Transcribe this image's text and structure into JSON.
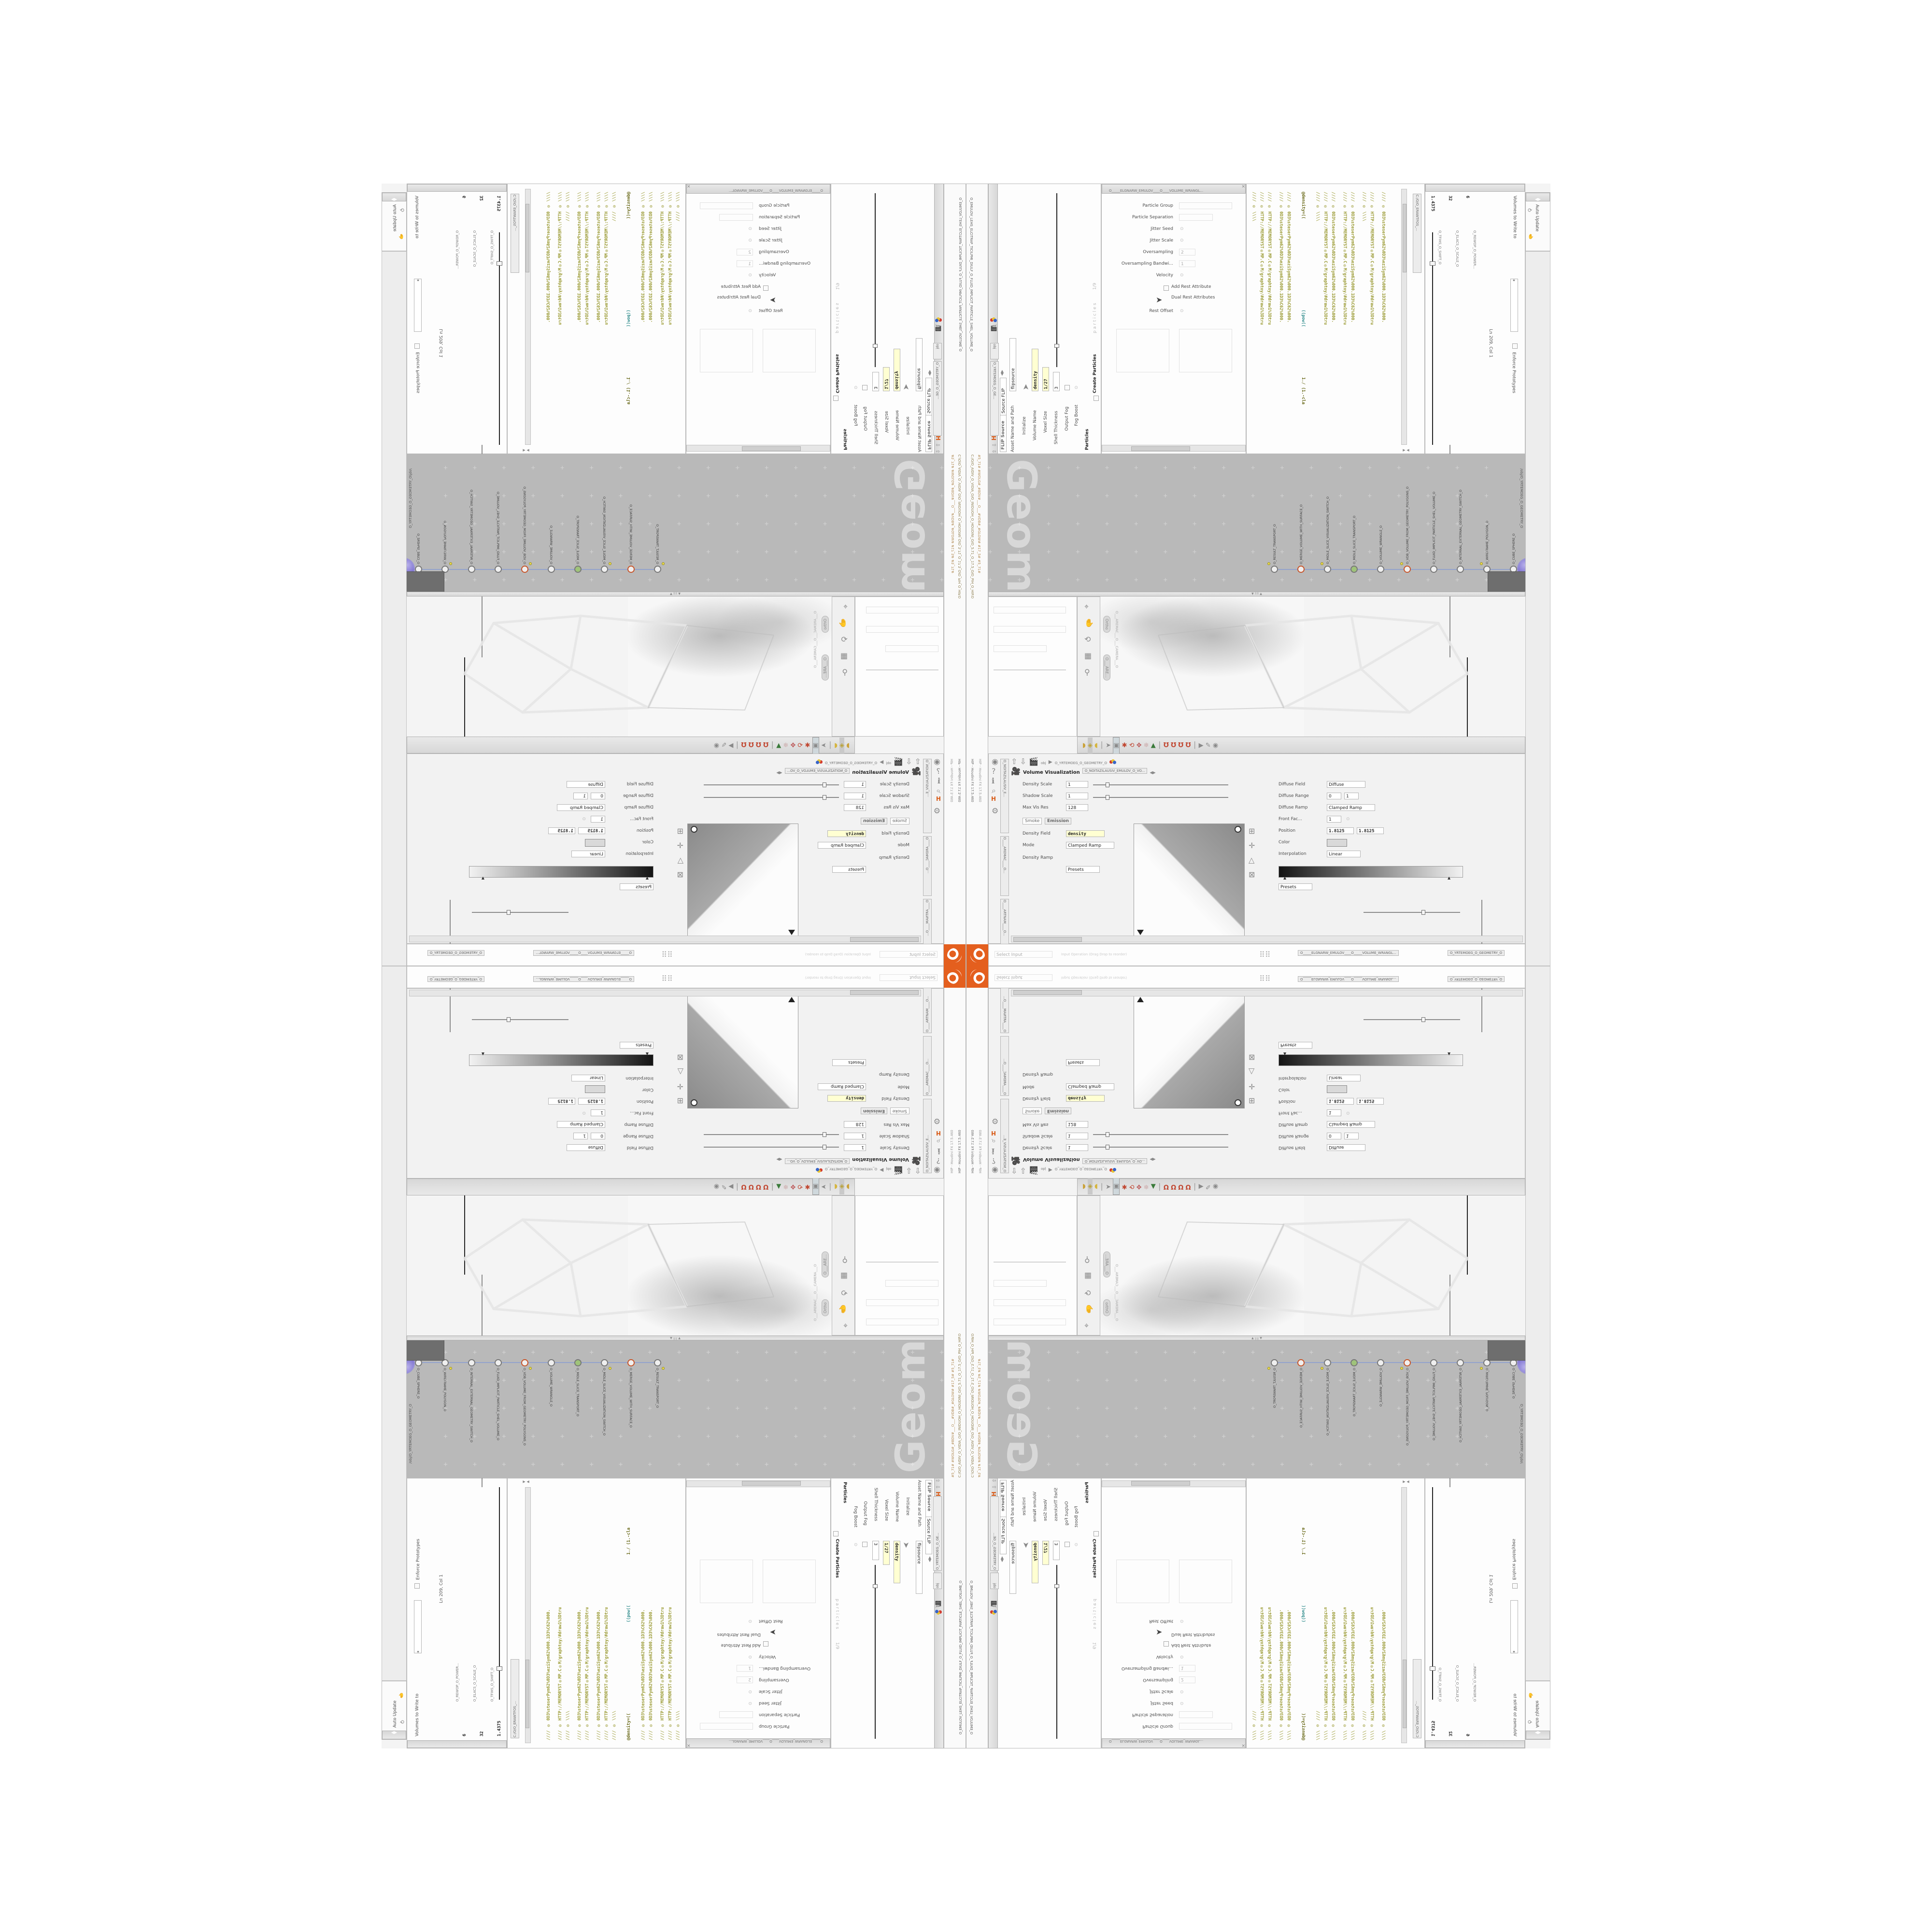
{
  "app": {
    "auto_update": "Auto Update",
    "taskbar": "HIP  -  Houdini FX 17.5.460",
    "title_path": "C:/O/O_AIDIV_O_VIDIA_O/O_INIDUOH_O_HOUDINI_O/O_5.71_O_17.5_O/O_PIH_O_HIP.O",
    "title_frames": "#5_71#   #WOLG#_#BDV#___O___#VDB#_#GLOW#   #17_5#   #5_71#"
  },
  "flip": {
    "window_tab": "O_EMULOV_LEHS_ELCITRAP_TICILPMI_DIULF_O_FLUID_IMPLICIT_PARTICLE_SHEL_VOLUME_O",
    "tab": "FLIP Source",
    "selector": "Source FLIP",
    "asset_label": "Asset Name and Path",
    "asset_value": "flipsource",
    "path_obj": "obj",
    "path_geo": "O_YRTEMOEG_O_GE...",
    "rows": [
      {
        "label": "Initialize",
        "value": ""
      },
      {
        "label": "Volume Name",
        "value": "density"
      },
      {
        "label": "Voxel Size",
        "value": "1/27"
      },
      {
        "label": "Shell Thickness",
        "value": "3"
      },
      {
        "label": "Output Fog",
        "value": ""
      },
      {
        "label": "Fog Boost",
        "value": ""
      }
    ],
    "particles_section": "Particles",
    "create_particles": "Create Particles",
    "ghost_name": "particles",
    "ghost_value": "1/9"
  },
  "pane2": {
    "tab": "O_____ELGNARW_EMULOV____O____VOLUME_WRANGL...",
    "rows": [
      {
        "label": "Particle Group",
        "value": ""
      },
      {
        "label": "Particle Separation",
        "value": ""
      },
      {
        "label": "Jitter Seed",
        "value": ""
      },
      {
        "label": "Jitter Scale",
        "value": ""
      },
      {
        "label": "Oversampling",
        "value": "2"
      },
      {
        "label": "Oversampling Bandwi...",
        "value": "1"
      },
      {
        "label": "Velocity",
        "value": ""
      }
    ],
    "add_rest": "Add Rest Attribute",
    "dual_rest": "Dual Rest Attributes",
    "rest_offset": "Rest Offset"
  },
  "wrangle": {
    "title": "Volume Wrangle",
    "asset_label": "Asset Name and Path",
    "asset_value": "volumewrangle",
    "file_tab": "C:/O/O_ERAWTFOS_...",
    "net_tab": "O_____ELGNARW_EMULOV____O_____VOLUME_WRANGL...",
    "geo_tab": "O_YRTEMOEG_O_GEOMETRY_O",
    "status": "Ln 209, Col 1",
    "volumes_label": "Volumes to Write to",
    "volumes_value": "*",
    "enforce": "Enforce Prototypes",
    "select_input": "Select Input",
    "input_op": "Input Operation (Drag Drop to reorder)",
    "params": [
      {
        "label": "O_REWOP_O_POWER...",
        "value": "6"
      },
      {
        "label": "O_ELACS_O_SCALE_O",
        "value": "32"
      },
      {
        "label": "O_TFIHS_O_SHIFT_O",
        "value": "1.4375"
      }
    ],
    "code_lines": [
      "//// ◎ \\\\\\\\",
      "//// ◎ HTTP://MEMORYST◎MP.C◎M/graphtoy/#draw1%3Dtru",
      "//// ◎ HTTP://MEMORYST◎MP.C◎M/graphtoy/#draw1%3Dtru",
      "//// ◎ 0D3%steserPym62%0D3%eziSym62%000.1D3%C62%000.",
      "//// ◎ 0D3%steserPym62%0D3%eziSym62%000.1D3%C62%000.",
      "//// ◎ \\\\\\\\",
      "//// ◎ HTTP://MEMORYST◎MP.C◎M/graphtoy/#draw1%3Dtru",
      "//// ◎ 0D3%steserPym62%0D3%eziSym62%000.1D3%C62%000."
    ],
    "code_line_main_a": "@density=((",
    "code_line_main_b": "((pow((",
    "code_line_main_c": "1./ (1.-cla"
  },
  "network": {
    "watermark": "Geometry",
    "context_tab": "/obj/O_YRTEMOEG_O_GEOMETRY_O",
    "nodes": [
      {
        "label": "O_RESULT_TRANSPORT_O"
      },
      {
        "label": "O_MERGE_VOLUME_WITH_SURFACE_O"
      },
      {
        "label": "O_MIDLE_SLICE_VISUALIZATION_SWITCH_O"
      },
      {
        "label": "O_MIDLE_SLICE_TRANSPORT_O"
      },
      {
        "label": "O_VOLUME_WRANGLE_O"
      },
      {
        "label": "O_VDB_VOLUME_FROM_GEOMETRY_POLYGONS_O"
      },
      {
        "label": "O_FLUID_IMPLICIT_PARTICLE_SHEL_VOLUME_O"
      },
      {
        "label": "O_INTERNAL_EXTERNAL_GEOMETRY_SWITCH_O"
      },
      {
        "label": "O_WIREFRAME_POLYGON_O"
      },
      {
        "label": "O_CUBE_SPHERE_O"
      }
    ]
  },
  "viewport": {
    "camera_label": "O___AREMAC___O___CAMERA___O",
    "ortho": "Ortho",
    "cam_pill": "O___ARE..."
  },
  "volviz": {
    "title": "Volume Visualization",
    "tab_side": "O_NOITAZILAUSIV_E...",
    "tab_main": "O_NOITAZILAUSIV_EMULOV_O_VO...",
    "tab_mantra": "O____ARTNAM____O...",
    "tab_camera": "O____AREMAC____O...",
    "path_obj": "obj",
    "path_geo": "O_YRTEMOEG_O_GEOMETRY_O",
    "rows": [
      {
        "label": "Density Scale",
        "value": "1"
      },
      {
        "label": "Shadow Scale",
        "value": "1"
      },
      {
        "label": "Max Vis Res",
        "value": "128"
      }
    ],
    "tab_smoke": "Smoke",
    "tab_emission": "Emission",
    "density_field_label": "Density Field",
    "density_field": "density",
    "mode_label": "Mode",
    "mode_value": "Clamped Ramp",
    "density_ramp": "Density Ramp",
    "diffuse_field_label": "Diffuse Field",
    "diffuse_field": "Diffuse",
    "diffuse_range": "Diffuse Range",
    "range_lo": "0",
    "range_hi": "1",
    "diffuse_ramp": "Diffuse Ramp",
    "clamped": "Clamped Ramp",
    "front": "Front Fac...",
    "front_value": "1",
    "position": "Position",
    "pos_values": [
      "1.8125",
      "1.8125"
    ],
    "color": "Color",
    "interpolation": "Interpolation",
    "linear": "Linear",
    "presets": "Presets"
  }
}
